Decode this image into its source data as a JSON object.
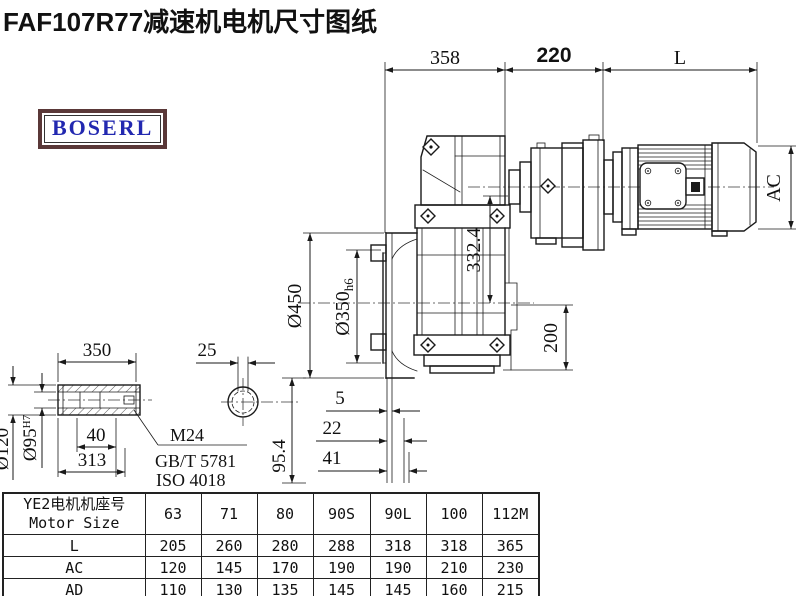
{
  "page": {
    "title": "FAF107R77减速机电机尺寸图纸"
  },
  "logo": {
    "text": "BOSERL"
  },
  "dims": {
    "d358": "358",
    "d220": "220",
    "dL": "L",
    "dAC": "AC",
    "d450": "Ø450",
    "d350": "Ø350",
    "d350tol": "h6",
    "d332": "332.4",
    "d200": "200",
    "d5": "5",
    "d22": "22",
    "d41": "41",
    "s350": "350",
    "s25": "25",
    "s40": "40",
    "s313": "313",
    "d120": "Ø120",
    "d95": "Ø95",
    "d95tol": "H7",
    "d954": "95.4",
    "m24": "M24",
    "gbt": "GB/T 5781",
    "iso": "ISO 4018"
  },
  "table": {
    "header_cn": "YE2电机机座号",
    "header_en": "Motor Size",
    "cols": [
      "63",
      "71",
      "80",
      "90S",
      "90L",
      "100",
      "112M"
    ],
    "rows": [
      {
        "label": "L",
        "v": [
          "205",
          "260",
          "280",
          "288",
          "318",
          "318",
          "365"
        ]
      },
      {
        "label": "AC",
        "v": [
          "120",
          "145",
          "170",
          "190",
          "190",
          "210",
          "230"
        ]
      },
      {
        "label": "AD",
        "v": [
          "110",
          "130",
          "135",
          "145",
          "145",
          "160",
          "215"
        ]
      }
    ]
  }
}
